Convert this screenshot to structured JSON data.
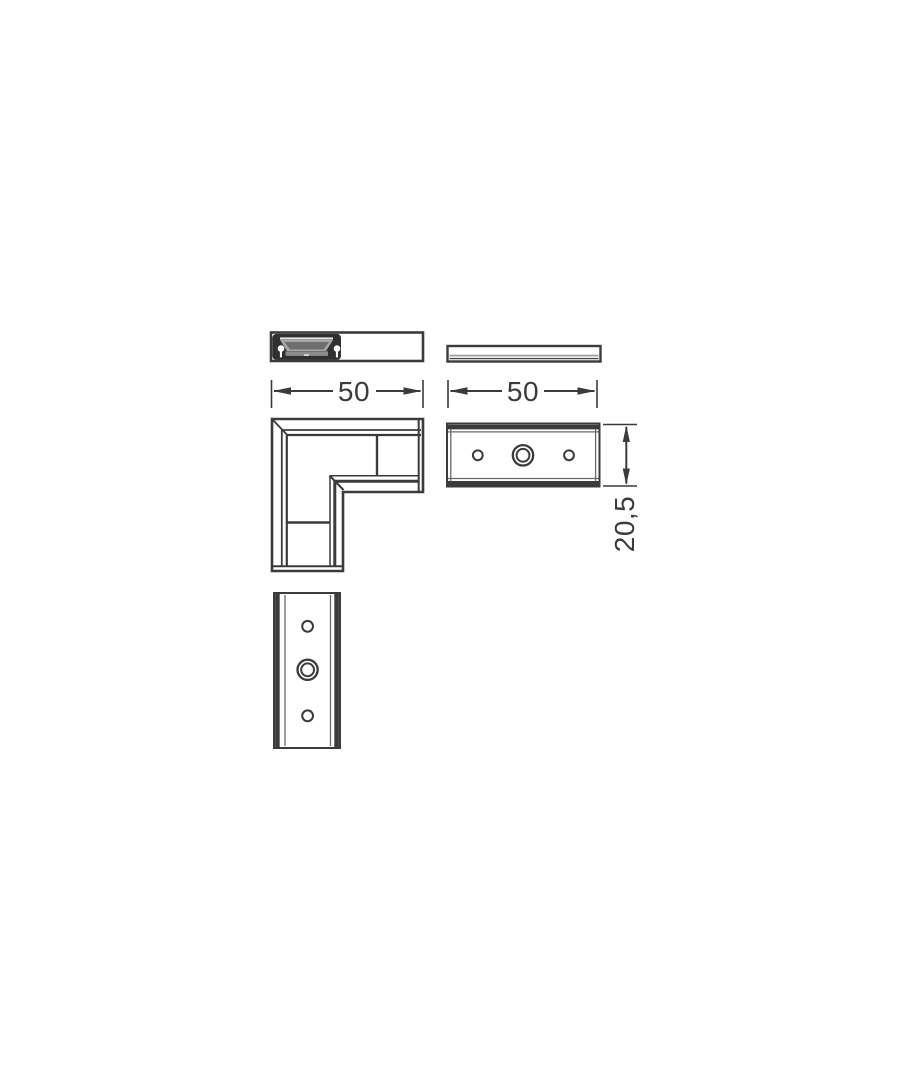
{
  "drawing": {
    "dimensions": {
      "profile_length_left": "50",
      "plate_length_right": "50",
      "plate_height": "20,5"
    },
    "colors": {
      "line": "#3b3b3b",
      "dark_fill": "#303030",
      "background": "#ffffff"
    }
  }
}
